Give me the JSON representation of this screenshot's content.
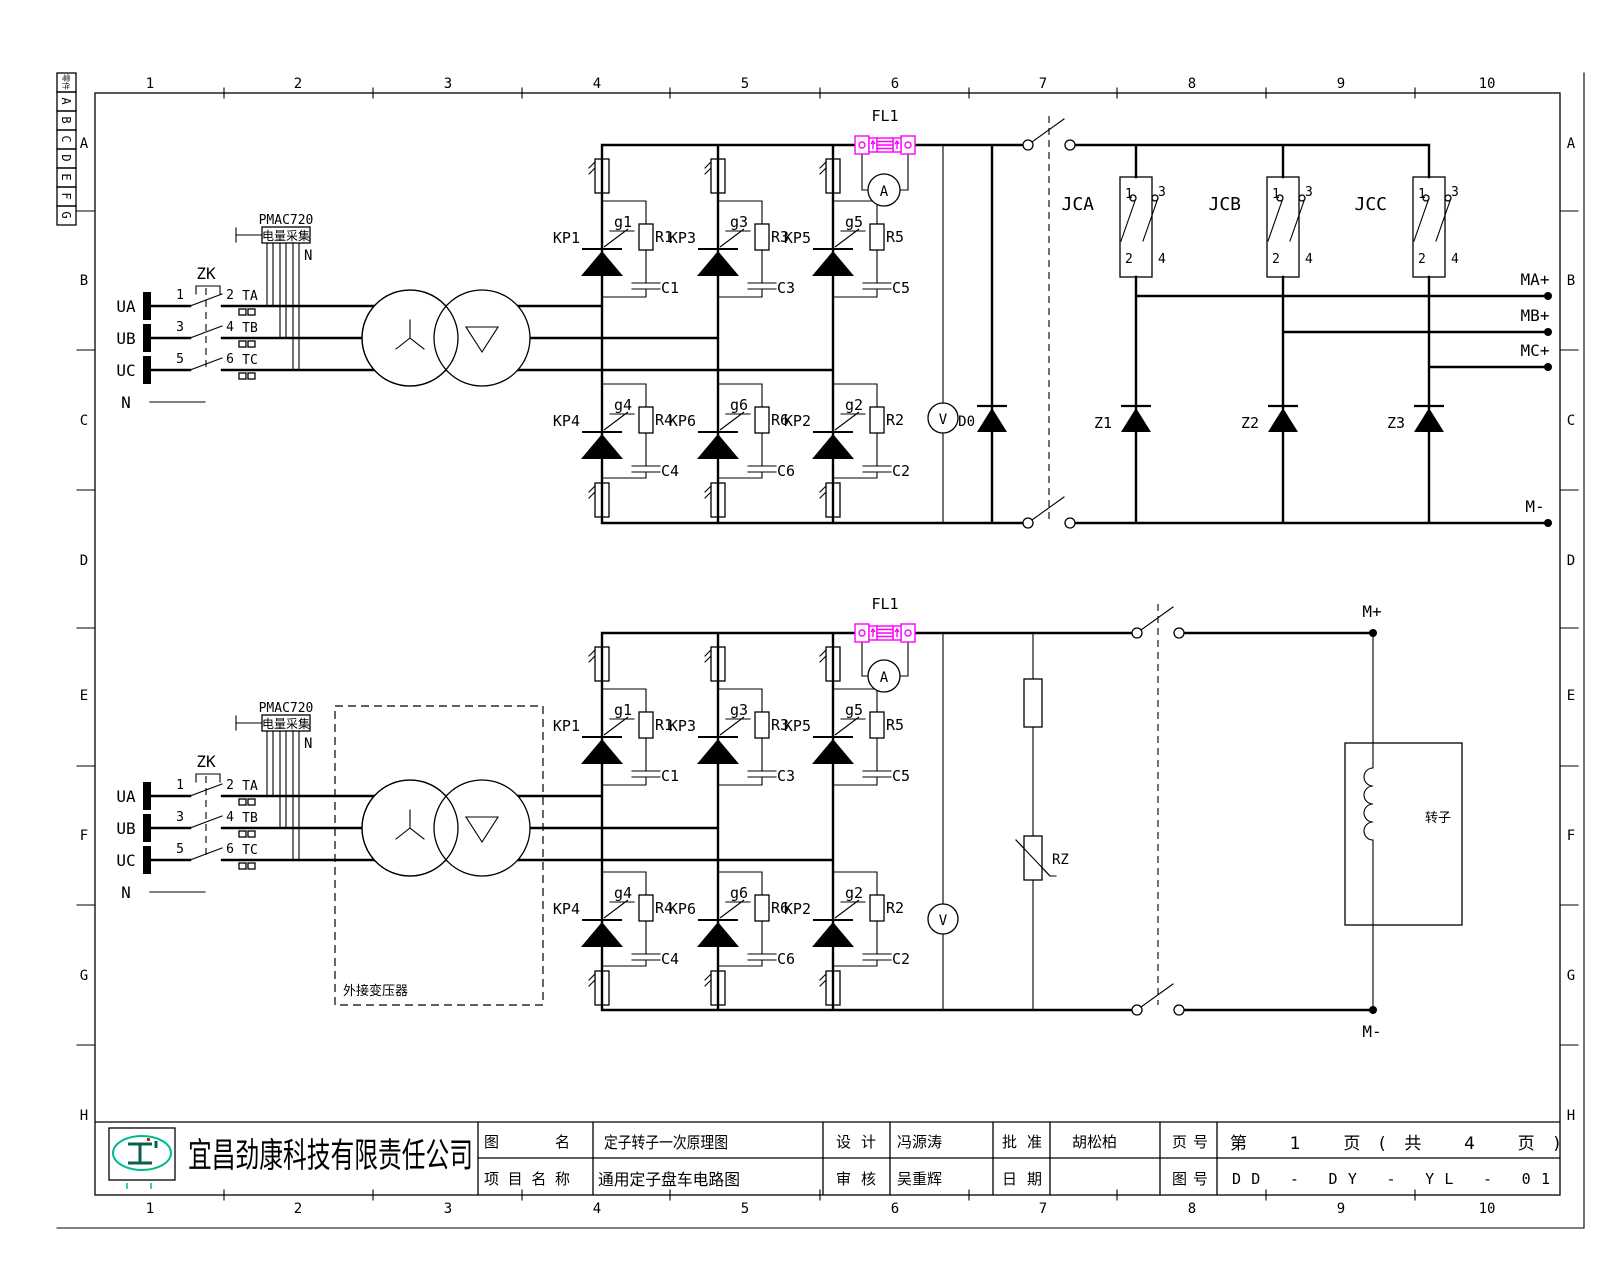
{
  "sheet": {
    "columns": [
      "1",
      "2",
      "3",
      "4",
      "5",
      "6",
      "7",
      "8",
      "9",
      "10"
    ],
    "rows": [
      "A",
      "B",
      "C",
      "D",
      "E",
      "F",
      "G",
      "H"
    ],
    "corner_strip": [
      "零件",
      "A",
      "B",
      "C",
      "D",
      "E",
      "F",
      "G"
    ]
  },
  "title_block": {
    "company": "宜昌劲康科技有限责任公司",
    "drawing_name_label": "图名",
    "drawing_name": "定子转子一次原理图",
    "project_name_label": "项目名称",
    "project_name": "通用定子盘车电路图",
    "design_label": "设计",
    "designer": "冯源涛",
    "review_label": "审核",
    "reviewer": "吴重辉",
    "approve_label": "批准",
    "approver": "胡松柏",
    "date_label": "日期",
    "date_value": "",
    "page_label": "页号",
    "page_value": "第 1 页(共 4 页)",
    "drawing_no_label": "图号",
    "drawing_no": "DD - DY - YL - 01"
  },
  "circuit": {
    "phase_a": "UA",
    "phase_b": "UB",
    "phase_c": "UC",
    "neutral": "N",
    "breaker": "ZK",
    "contact_nums": [
      "1",
      "2",
      "3",
      "4",
      "5",
      "6"
    ],
    "ct_a": "TA",
    "ct_b": "TB",
    "ct_c": "TC",
    "pmu_model": "PMAC720",
    "pmu_name": "电量采集",
    "pmu_n": "N",
    "bridge": [
      {
        "kp": "KP1",
        "g": "g1",
        "r": "R1",
        "c": "C1"
      },
      {
        "kp": "KP3",
        "g": "g3",
        "r": "R3",
        "c": "C3"
      },
      {
        "kp": "KP5",
        "g": "g5",
        "r": "R5",
        "c": "C5"
      },
      {
        "kp": "KP4",
        "g": "g4",
        "r": "R4",
        "c": "C4"
      },
      {
        "kp": "KP6",
        "g": "g6",
        "r": "R6",
        "c": "C6"
      },
      {
        "kp": "KP2",
        "g": "g2",
        "r": "R2",
        "c": "C2"
      }
    ],
    "shunt": "FL1",
    "ammeter": "A",
    "voltmeter": "V"
  },
  "top_circuit": {
    "freewheel_diode": "D0",
    "contactors": [
      "JCA",
      "JCB",
      "JCC"
    ],
    "jc_terms": [
      "1",
      "2",
      "3",
      "4"
    ],
    "diodes": [
      "Z1",
      "Z2",
      "Z3"
    ],
    "out_a": "MA+",
    "out_b": "MB+",
    "out_c": "MC+",
    "out_neg": "M-"
  },
  "bottom_circuit": {
    "ext_transformer": "外接变压器",
    "varistor": "RZ",
    "rotor": "转子",
    "out_pos": "M+",
    "out_neg": "M-"
  },
  "colors": {
    "shunt": "#ff00ff",
    "logo": "#00b98e",
    "line": "#000000",
    "background": "#ffffff"
  }
}
